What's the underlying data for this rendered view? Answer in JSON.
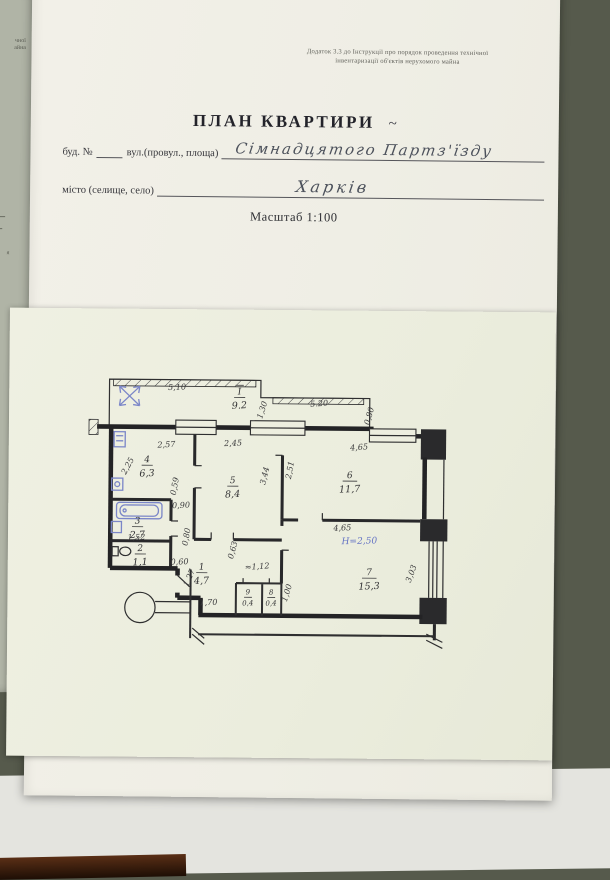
{
  "colors": {
    "backdrop": "#565a4c",
    "page": "#f1efe7",
    "plan_sheet": "#edeedf",
    "ink": "#2e2e30",
    "blue_ink": "#6473c4",
    "handwriting": "#4d525c"
  },
  "side_page": {
    "fragment1": "чної",
    "fragment2": "айна",
    "fragment3": "я"
  },
  "header_note": {
    "line1": "Додаток 3.3 до Інструкції про порядок проведення технічної",
    "line2": "інвентаризації об'єктів нерухомого майна"
  },
  "title": "ПЛАН КВАРТИРИ",
  "title_mark": "~",
  "fields": {
    "building_label": "буд. №",
    "street_label": "вул.(провул., площа)",
    "street_value": "Сімнадцятого Партз'їзду",
    "city_label": "місто (селище, село)",
    "city_value": "Харків"
  },
  "scale_label": "Масштаб 1:100",
  "plan": {
    "rooms": [
      {
        "num": "I",
        "area": "9.2",
        "x": 157,
        "y": 24,
        "roman": true
      },
      {
        "num": "4",
        "area": "6,3",
        "x": 66,
        "y": 92
      },
      {
        "num": "5",
        "area": "8,4",
        "x": 151,
        "y": 112
      },
      {
        "num": "6",
        "area": "11,7",
        "x": 267,
        "y": 106
      },
      {
        "num": "3",
        "area": "2,7",
        "x": 57,
        "y": 153
      },
      {
        "num": "2",
        "area": "1,1",
        "x": 60,
        "y": 180
      },
      {
        "num": "1",
        "area": "4,7",
        "x": 121,
        "y": 198
      },
      {
        "num": "9",
        "area": "0,4",
        "x": 167,
        "y": 222,
        "small": true
      },
      {
        "num": "8",
        "area": "0,4",
        "x": 190,
        "y": 222,
        "small": true
      },
      {
        "num": "7",
        "area": "15,3",
        "x": 287,
        "y": 202
      }
    ],
    "dims": [
      {
        "text": "5,10",
        "x": 95,
        "y": 20,
        "rot": -2
      },
      {
        "text": "1,30",
        "x": 182,
        "y": 40,
        "rot": -73
      },
      {
        "text": "5.20",
        "x": 236,
        "y": 35,
        "rot": -4
      },
      {
        "text": "0,80",
        "x": 288,
        "y": 45,
        "rot": -75
      },
      {
        "text": "2,57",
        "x": 85,
        "y": 77,
        "rot": -3
      },
      {
        "text": "2,45",
        "x": 151,
        "y": 75,
        "rot": -3
      },
      {
        "text": "4,65",
        "x": 276,
        "y": 78,
        "rot": -5
      },
      {
        "text": "2,25",
        "x": 49,
        "y": 97,
        "rot": -62
      },
      {
        "text": "0,59",
        "x": 96,
        "y": 116,
        "rot": -80
      },
      {
        "text": "3,44",
        "x": 185,
        "y": 105,
        "rot": -77
      },
      {
        "text": "2,51",
        "x": 210,
        "y": 99,
        "rot": -80
      },
      {
        "text": "0,90",
        "x": 100,
        "y": 137,
        "rot": -3
      },
      {
        "text": "0,80",
        "x": 108,
        "y": 166,
        "rot": -80
      },
      {
        "text": "1,52",
        "x": 56,
        "y": 169,
        "rot": -2
      },
      {
        "text": "0,60",
        "x": 99,
        "y": 193,
        "rot": -2
      },
      {
        "text": "1,27",
        "x": 111,
        "y": 207,
        "rot": -68
      },
      {
        "text": "1,70",
        "x": 128,
        "y": 233,
        "rot": -2
      },
      {
        "text": "0,63",
        "x": 154,
        "y": 179,
        "rot": -75
      },
      {
        "text": "≈1,12",
        "x": 176,
        "y": 197,
        "rot": -4
      },
      {
        "text": "1,00",
        "x": 208,
        "y": 221,
        "rot": -73
      },
      {
        "text": "4,65",
        "x": 260,
        "y": 158,
        "rot": -3
      },
      {
        "text": "Н=2,50",
        "x": 277,
        "y": 171,
        "rot": -2,
        "blue": true
      },
      {
        "text": "3,03",
        "x": 331,
        "y": 201,
        "rot": -70
      }
    ]
  }
}
